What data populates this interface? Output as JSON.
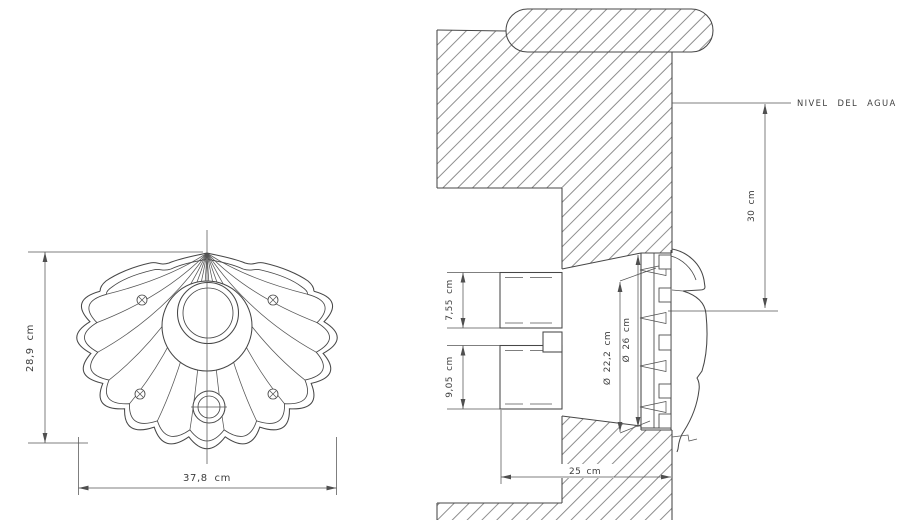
{
  "front_view": {
    "height_label": "28,9 cm",
    "width_label": "37,8 cm"
  },
  "section_view": {
    "water_level_label": "NIVEL DEL AGUA",
    "water_to_center_label": "30 cm",
    "upper_conduit_label": "7,55 cm",
    "lower_conduit_label": "9,05 cm",
    "lamp_diameter_label": "Ø 22,2 cm",
    "niche_diameter_label": "Ø 26 cm",
    "niche_depth_label": "25 cm"
  },
  "colors": {
    "background": "#ffffff",
    "line_color": "#474747",
    "hatch_color": "#7a7a7a",
    "text_color": "#3d3d3d"
  }
}
